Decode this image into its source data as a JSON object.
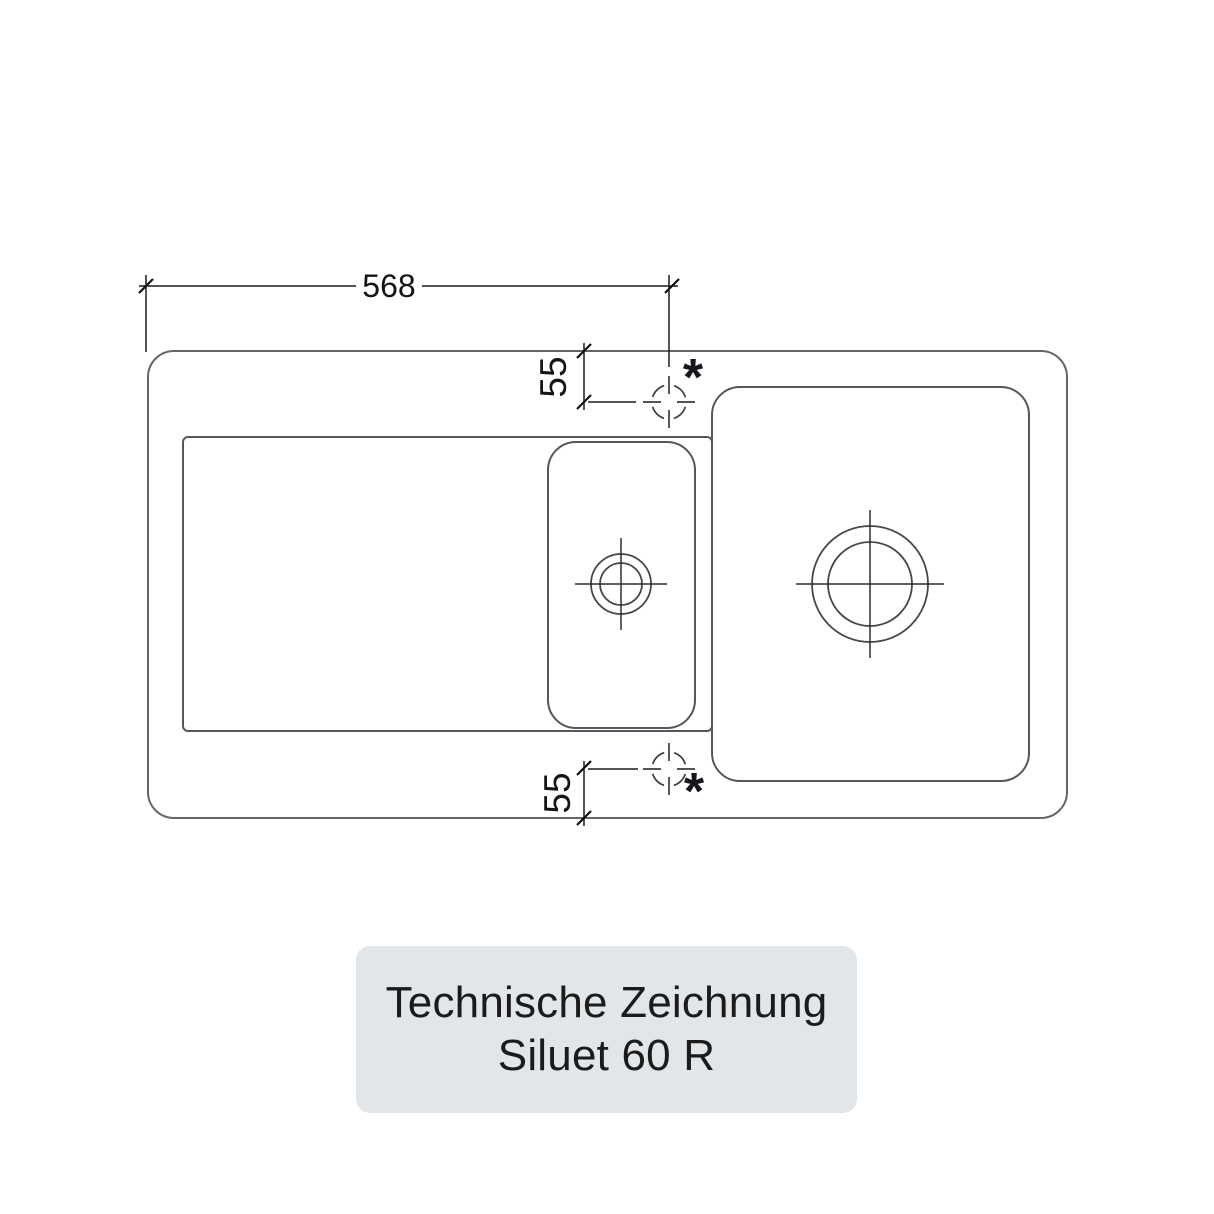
{
  "drawing": {
    "width_dimension": "568",
    "tap_offset_top": "55",
    "tap_offset_bottom": "55",
    "tap_marker_top": "*",
    "tap_marker_bottom": "*"
  },
  "label_card": {
    "title": "Technische Zeichnung",
    "model": "Siluet 60 R"
  },
  "colors": {
    "outline_gray": "#63676b",
    "bowl_gray": "#54585c",
    "dimension_black": "#1c1c1e",
    "label_background": "#e2e6e9",
    "label_text": "#1b1b1b"
  }
}
